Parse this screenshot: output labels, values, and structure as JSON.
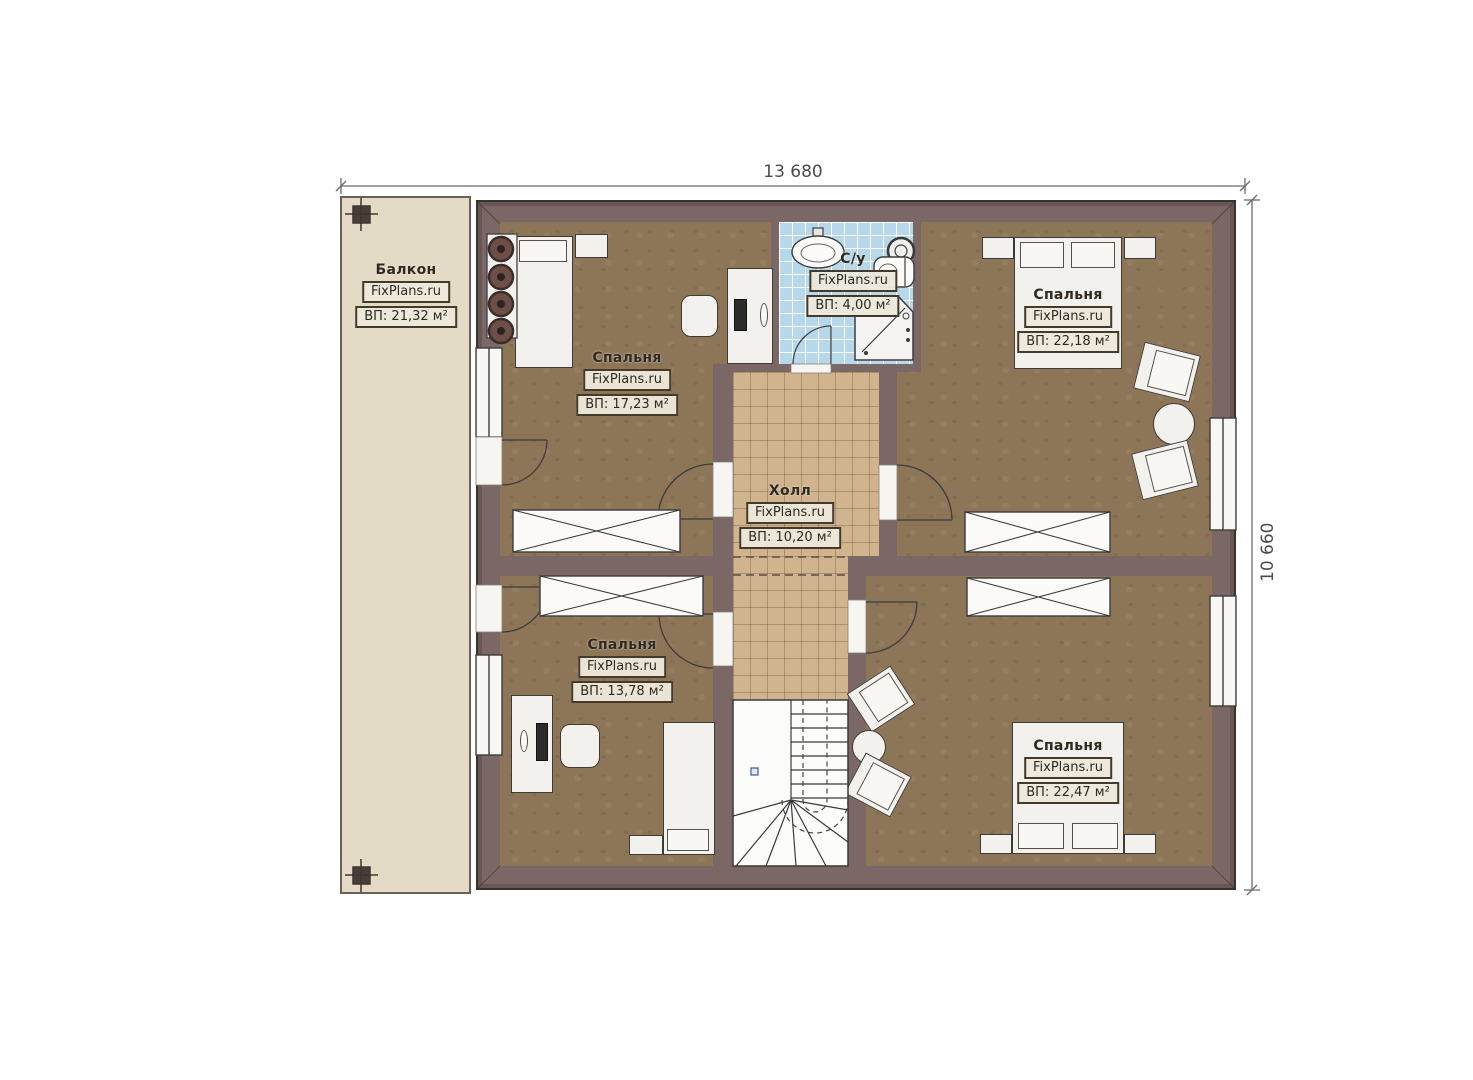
{
  "dimensions": {
    "width": "13 680",
    "height": "10 660"
  },
  "rooms": {
    "balcony": {
      "name": "Балкон",
      "brand": "FixPlans.ru",
      "area": "ВП: 21,32 м²"
    },
    "bedroom_top_left": {
      "name": "Спальня",
      "brand": "FixPlans.ru",
      "area": "ВП: 17,23 м²"
    },
    "bathroom": {
      "name": "С/у",
      "brand": "FixPlans.ru",
      "area": "ВП: 4,00 м²"
    },
    "bedroom_top_right": {
      "name": "Спальня",
      "brand": "FixPlans.ru",
      "area": "ВП: 22,18 м²"
    },
    "hall": {
      "name": "Холл",
      "brand": "FixPlans.ru",
      "area": "ВП: 10,20 м²"
    },
    "bedroom_bottom_left": {
      "name": "Спальня",
      "brand": "FixPlans.ru",
      "area": "ВП: 13,78 м²"
    },
    "bedroom_bottom_right": {
      "name": "Спальня",
      "brand": "FixPlans.ru",
      "area": "ВП: 22,47 м²"
    }
  },
  "colors": {
    "wall": "#7b6765",
    "floor": "#8d7557",
    "hallFloor": "#cfb48e",
    "tile": "#b6d8ea",
    "balconyFloor": "#e4dbc6",
    "furniture": "#f2f1ee"
  }
}
